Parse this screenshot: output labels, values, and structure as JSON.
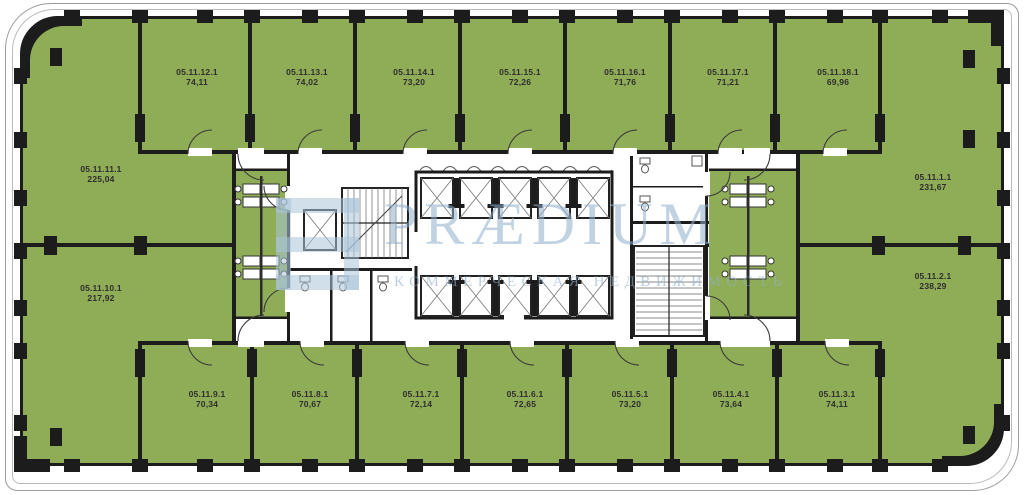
{
  "plan": {
    "watermark": {
      "brand": "PRÆDIUM",
      "tagline": "КОММЕРЧЕСКАЯ НЕДВИЖИМОСТЬ"
    },
    "colors": {
      "room_fill": "#8FAD57",
      "wall": "#1C1C1C",
      "watermark_text": "#8FB0CC"
    },
    "rooms": {
      "top": [
        {
          "id": "05.11.12.1",
          "area": "74,11"
        },
        {
          "id": "05.11.13.1",
          "area": "74,02"
        },
        {
          "id": "05.11.14.1",
          "area": "73,20"
        },
        {
          "id": "05.11.15.1",
          "area": "72,26"
        },
        {
          "id": "05.11.16.1",
          "area": "71,76"
        },
        {
          "id": "05.11.17.1",
          "area": "71,21"
        },
        {
          "id": "05.11.18.1",
          "area": "69,96"
        }
      ],
      "left": [
        {
          "id": "05.11.11.1",
          "area": "225,04"
        },
        {
          "id": "05.11.10.1",
          "area": "217,92"
        }
      ],
      "right": [
        {
          "id": "05.11.1.1",
          "area": "231,67"
        },
        {
          "id": "05.11.2.1",
          "area": "238,29"
        }
      ],
      "bottom": [
        {
          "id": "05.11.9.1",
          "area": "70,34"
        },
        {
          "id": "05.11.8.1",
          "area": "70,67"
        },
        {
          "id": "05.11.7.1",
          "area": "72,14"
        },
        {
          "id": "05.11.6.1",
          "area": "72,65"
        },
        {
          "id": "05.11.5.1",
          "area": "73,20"
        },
        {
          "id": "05.11.4.1",
          "area": "73,64"
        },
        {
          "id": "05.11.3.1",
          "area": "74,11"
        }
      ]
    }
  }
}
